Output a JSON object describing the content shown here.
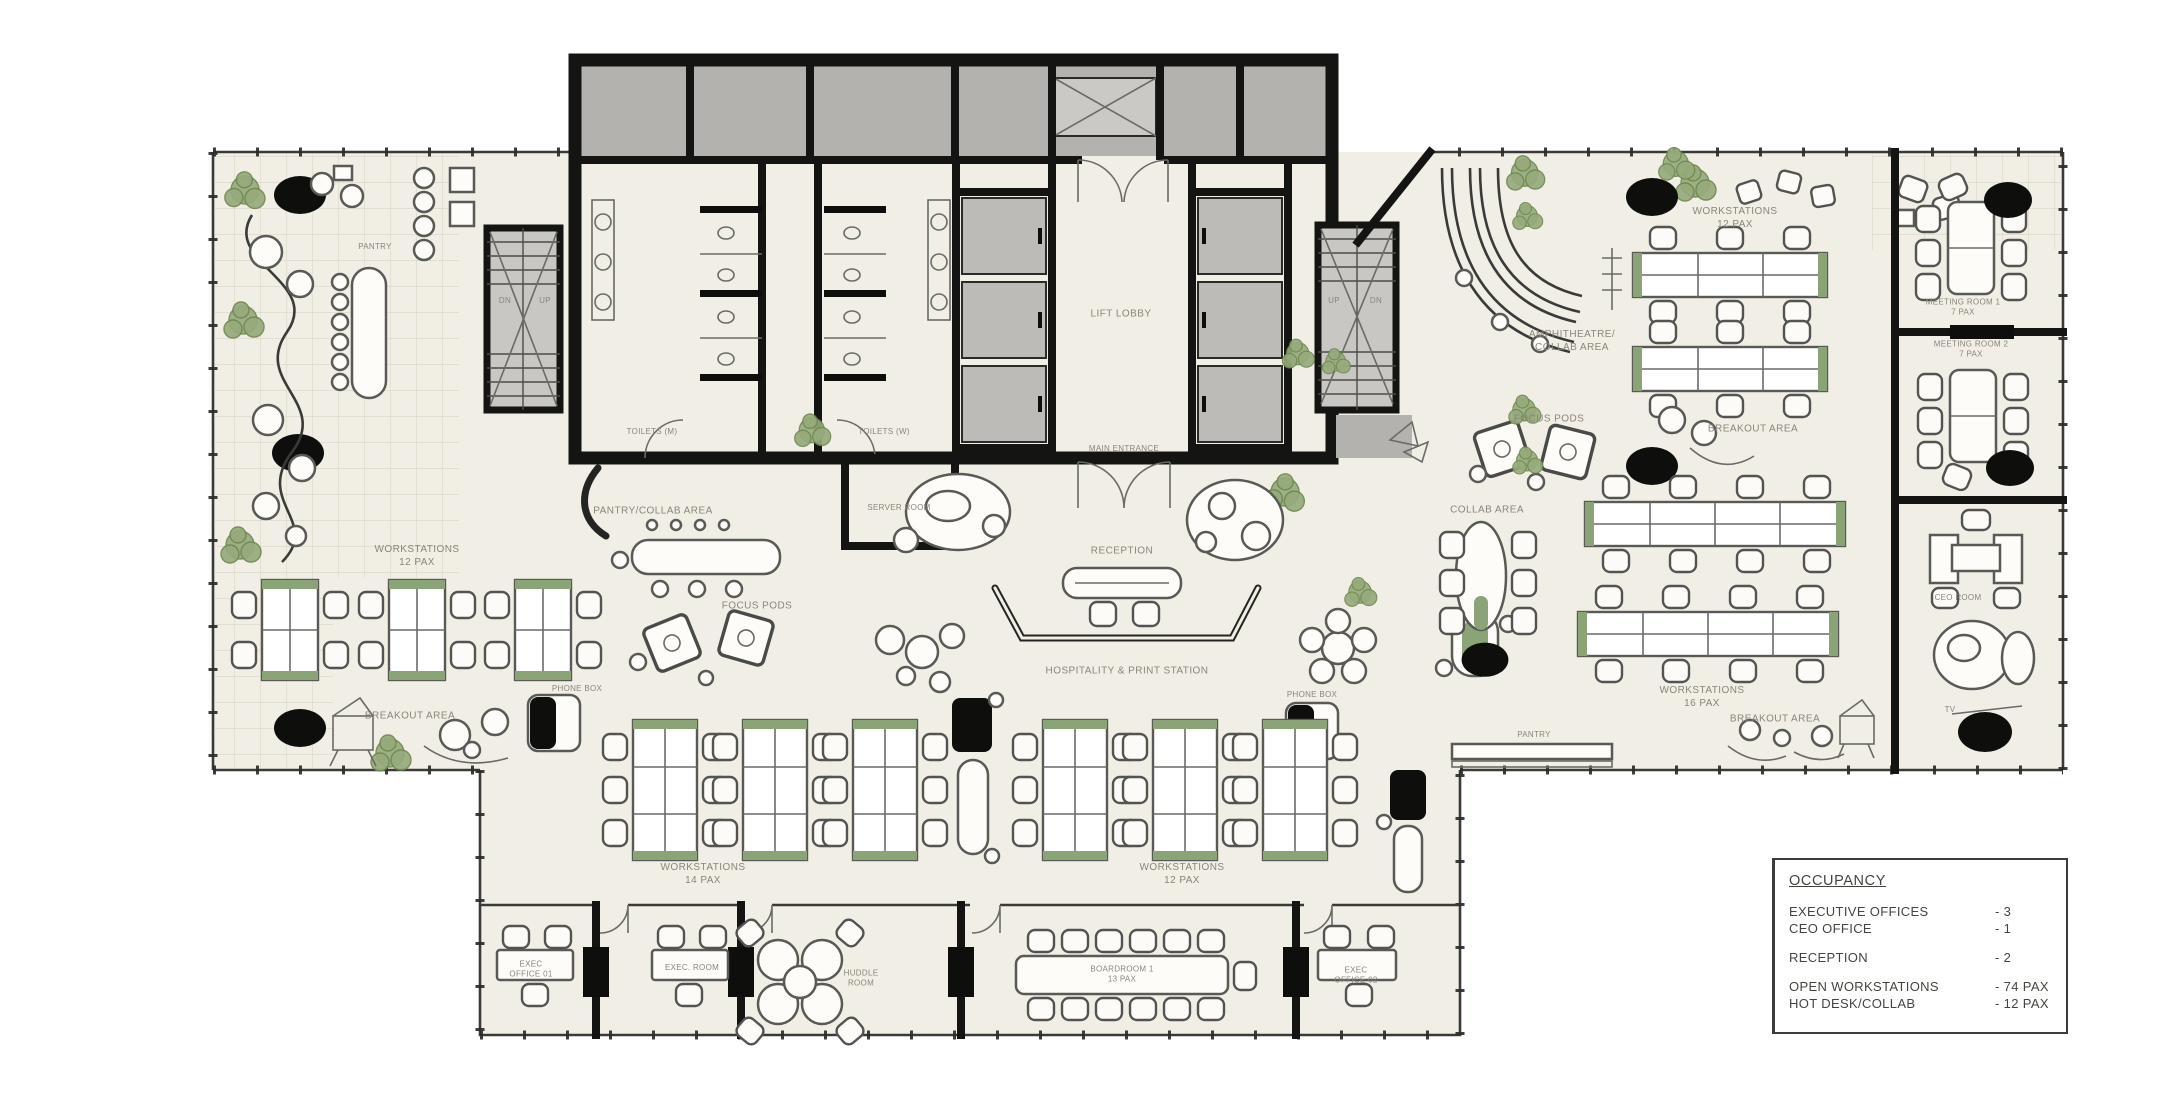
{
  "colors": {
    "wall": "#141412",
    "floor": "#f1eee6",
    "gray_room": "#b3b2ae",
    "lift": "#bcbbb7",
    "green": "#8aa477",
    "tree": "#96aa7c",
    "black": "#0e0e0c",
    "label_text": "#8a857b",
    "legend_text": "#45453f"
  },
  "legend": {
    "title": "OCCUPANCY",
    "rows": [
      {
        "label": "EXECUTIVE OFFICES",
        "value": "- 3"
      },
      {
        "label": "CEO OFFICE",
        "value": "- 1"
      },
      {
        "label": "",
        "value": "",
        "cls": "gap"
      },
      {
        "label": "RECEPTION",
        "value": "- 2"
      },
      {
        "label": "",
        "value": "",
        "cls": "gap"
      },
      {
        "label": "OPEN WORKSTATIONS",
        "value": "- 74 PAX"
      },
      {
        "label": "HOT DESK/COLLAB",
        "value": "- 12 PAX"
      }
    ]
  },
  "plan_labels": [
    {
      "lines": [
        "PANTRY"
      ],
      "x": 375,
      "y": 247,
      "cls": "tiny"
    },
    {
      "lines": [
        "WORKSTATIONS",
        "12 PAX"
      ],
      "x": 417,
      "y": 556
    },
    {
      "lines": [
        "BREAKOUT AREA"
      ],
      "x": 410,
      "y": 716
    },
    {
      "lines": [
        "PHONE BOX"
      ],
      "x": 577,
      "y": 689,
      "cls": "tiny"
    },
    {
      "lines": [
        "PANTRY/COLLAB AREA"
      ],
      "x": 653,
      "y": 511
    },
    {
      "lines": [
        "TOILETS (M)"
      ],
      "x": 652,
      "y": 432,
      "cls": "tiny"
    },
    {
      "lines": [
        "TOILETS (W)"
      ],
      "x": 884,
      "y": 432,
      "cls": "tiny"
    },
    {
      "lines": [
        "SERVER ROOM"
      ],
      "x": 899,
      "y": 508,
      "cls": "tiny"
    },
    {
      "lines": [
        "LIFT LOBBY"
      ],
      "x": 1121,
      "y": 314
    },
    {
      "lines": [
        "MAIN ENTRANCE"
      ],
      "x": 1124,
      "y": 449,
      "cls": "tiny"
    },
    {
      "lines": [
        "RECEPTION"
      ],
      "x": 1122,
      "y": 551
    },
    {
      "lines": [
        "HOSPITALITY & PRINT STATION"
      ],
      "x": 1127,
      "y": 671
    },
    {
      "lines": [
        "FOCUS PODS"
      ],
      "x": 757,
      "y": 606
    },
    {
      "lines": [
        "PHONE BOX"
      ],
      "x": 1312,
      "y": 695,
      "cls": "tiny"
    },
    {
      "lines": [
        "WORKSTATIONS",
        "12 PAX"
      ],
      "x": 1735,
      "y": 218
    },
    {
      "lines": [
        "AMPHITHEATRE/",
        "COLLAB AREA"
      ],
      "x": 1572,
      "y": 341
    },
    {
      "lines": [
        "FOCUS PODS"
      ],
      "x": 1549,
      "y": 419
    },
    {
      "lines": [
        "BREAKOUT AREA"
      ],
      "x": 1753,
      "y": 429
    },
    {
      "lines": [
        "COLLAB AREA"
      ],
      "x": 1487,
      "y": 510
    },
    {
      "lines": [
        "WORKSTATIONS",
        "16 PAX"
      ],
      "x": 1702,
      "y": 697
    },
    {
      "lines": [
        "PANTRY"
      ],
      "x": 1534,
      "y": 735,
      "cls": "tiny"
    },
    {
      "lines": [
        "BREAKOUT AREA"
      ],
      "x": 1775,
      "y": 719
    },
    {
      "lines": [
        "MEETING ROOM 1",
        "7 PAX"
      ],
      "x": 1963,
      "y": 308,
      "cls": "tiny"
    },
    {
      "lines": [
        "MEETING ROOM 2",
        "7 PAX"
      ],
      "x": 1971,
      "y": 350,
      "cls": "tiny"
    },
    {
      "lines": [
        "CEO ROOM"
      ],
      "x": 1958,
      "y": 598,
      "cls": "tiny"
    },
    {
      "lines": [
        "TV"
      ],
      "x": 1950,
      "y": 710,
      "cls": "tiny"
    },
    {
      "lines": [
        "WORKSTATIONS",
        "14 PAX"
      ],
      "x": 703,
      "y": 874
    },
    {
      "lines": [
        "WORKSTATIONS",
        "12 PAX"
      ],
      "x": 1182,
      "y": 874
    },
    {
      "lines": [
        "EXEC",
        "OFFICE 01"
      ],
      "x": 531,
      "y": 970,
      "cls": "tiny"
    },
    {
      "lines": [
        "EXEC. ROOM"
      ],
      "x": 692,
      "y": 968,
      "cls": "tiny"
    },
    {
      "lines": [
        "HUDDLE",
        "ROOM"
      ],
      "x": 861,
      "y": 979,
      "cls": "tiny"
    },
    {
      "lines": [
        "BOARDROOM 1",
        "13 PAX"
      ],
      "x": 1122,
      "y": 975,
      "cls": "tiny"
    },
    {
      "lines": [
        "EXEC",
        "OFFICE 02"
      ],
      "x": 1356,
      "y": 976,
      "cls": "tiny"
    },
    {
      "lines": [
        "DN"
      ],
      "x": 505,
      "y": 301,
      "cls": "tiny"
    },
    {
      "lines": [
        "UP"
      ],
      "x": 545,
      "y": 301,
      "cls": "tiny"
    },
    {
      "lines": [
        "UP"
      ],
      "x": 1334,
      "y": 301,
      "cls": "tiny"
    },
    {
      "lines": [
        "DN"
      ],
      "x": 1376,
      "y": 301,
      "cls": "tiny"
    }
  ]
}
